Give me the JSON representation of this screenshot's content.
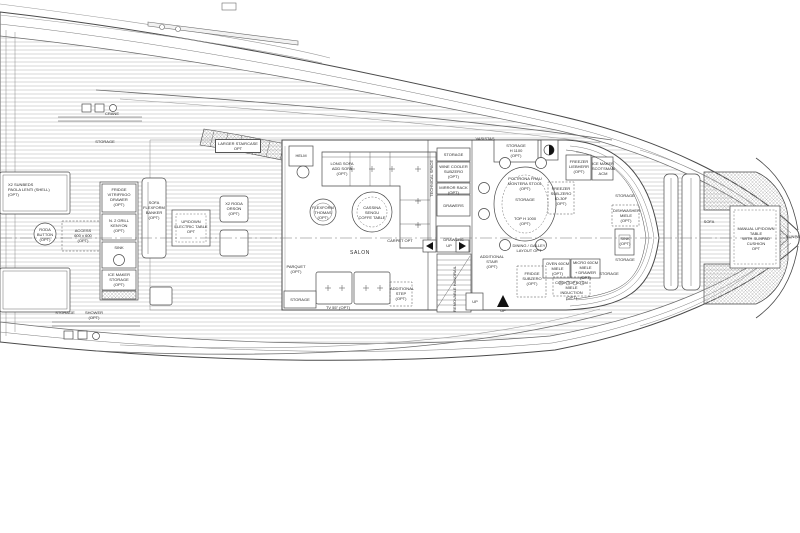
{
  "colors": {
    "background": "#ffffff",
    "line": "#4a4a4a",
    "line_light": "#9a9a9a",
    "plank": "#b8b8b8",
    "hatch": "#a8a8a8",
    "text": "#2b2b2b",
    "solid_marker": "#111111"
  },
  "exterior": {
    "crane": "CRANE",
    "storage_aft_port": "STORAGE",
    "storage_aft_stbd": "STORAGE",
    "shower_aft_stbd": "SHOWER (OPT)",
    "sunbeds": "X2 SUNBEDS\nPAOLA LENTI (SHELL)\n(OPT)",
    "roda_button": "RODA\nBUTTON\n(OPT)",
    "access": "ACCESS\n600 x 600\n(OPT)",
    "wetbar_fridge": "FRIDGE\nVITRIFRIGO\nDRAWER\n(OPT)",
    "wetbar_grill": "N. 2 GRILL\nKENYON\n(OPT)",
    "wetbar_sink": "SINK",
    "wetbar_icemaker": "ICE MAKER\nSTORAGE\n(OPT)",
    "sofa_banker": "SOFA\nFLEXFORM\nBANKER\n(OPT)",
    "updown_table": "UP/DOWN\nELECTRIC TABLE\nOPT",
    "roda_orson": "X2 RODA\nORSON\n(OPT)",
    "larger_staircase": "LARGER STAIRCASE\nOPT"
  },
  "salon": {
    "helm": "HELM",
    "sofa": "LONG SOFA\nADD SOFA\n(OPT)",
    "armchair": "FLEXFORM\nTHOMAS\n(OPT)",
    "coffee_table": "CASSINA\nSENGU\nCOFFE TABLE",
    "carpet": "CARPET OPT",
    "room": "SALON",
    "parquet": "PARQUET\n(OPT)",
    "storage": "STORAGE",
    "tv": "TV 55\" (OPT)",
    "additional_step": "ADDITIONAL\nSTEP\n(OPT)"
  },
  "galley": {
    "technical_space": "TECHNICAL SPACE",
    "storage_aft": "STORAGE",
    "wine_cooler": "WINE COOLER\nSUBZERO\n(OPT)",
    "mirror_rack": "MIRROR RACK\n(OPT)",
    "drawers_1": "DRAWERS",
    "drawers_2": "DRAWERS",
    "up_side": "UP",
    "handrail": "REMOVABLE HANDRAIL",
    "up_stair": "UP",
    "vasistas": "VASISTAS",
    "storage_h1100": "STORAGE\nH 1100\n(OPT)",
    "stools": "POLTRONA FRAU\nMONTERA STOOL\n(OPT)",
    "table_storage": "STORAGE",
    "top_h1000": "TOP H 1000\n(OPT)",
    "freezer_subzero": "FREEZER\nSUB-ZERO\nID-30F\n(OPT)",
    "freezer_liebherr": "FREEZER\nLIEBHERR\n(OPT)",
    "ice_maker": "ICE MAKER\nSCOTSMAN\nACM",
    "dining_layout": "DINING / GALLEY\nLAYOUT OPT",
    "storage_fwd_1": "STORAGE",
    "dishwasher": "DISHWASHER\nMIELE\n(OPT)",
    "sink_fwd": "SINK\n(OPT)",
    "storage_fwd_2": "STORAGE",
    "additional_stair": "ADDITIONAL\nSTAIR\n(OPT)",
    "oven": "OVEN 60CM\nMIELE\n(OPT)",
    "microwave": "MICRO 60CM\nMIELE\n+ DRAWER\n(OPT)",
    "storage_fwd_3": "STORAGE",
    "fridge_subzero": "FRIDGE\nSUBZERO\n(OPT)",
    "cooktop": "COOKTOP 60 CM\nMIELE INDUCTION\n(OPT)",
    "up_lower": "UP"
  },
  "bow": {
    "sofa": "SOFA",
    "manual_table": "MANUAL UP/DOWN TABLE\nWITH SUNPAD CUSHION\nOPT",
    "sunpad": "SUNPAD"
  }
}
